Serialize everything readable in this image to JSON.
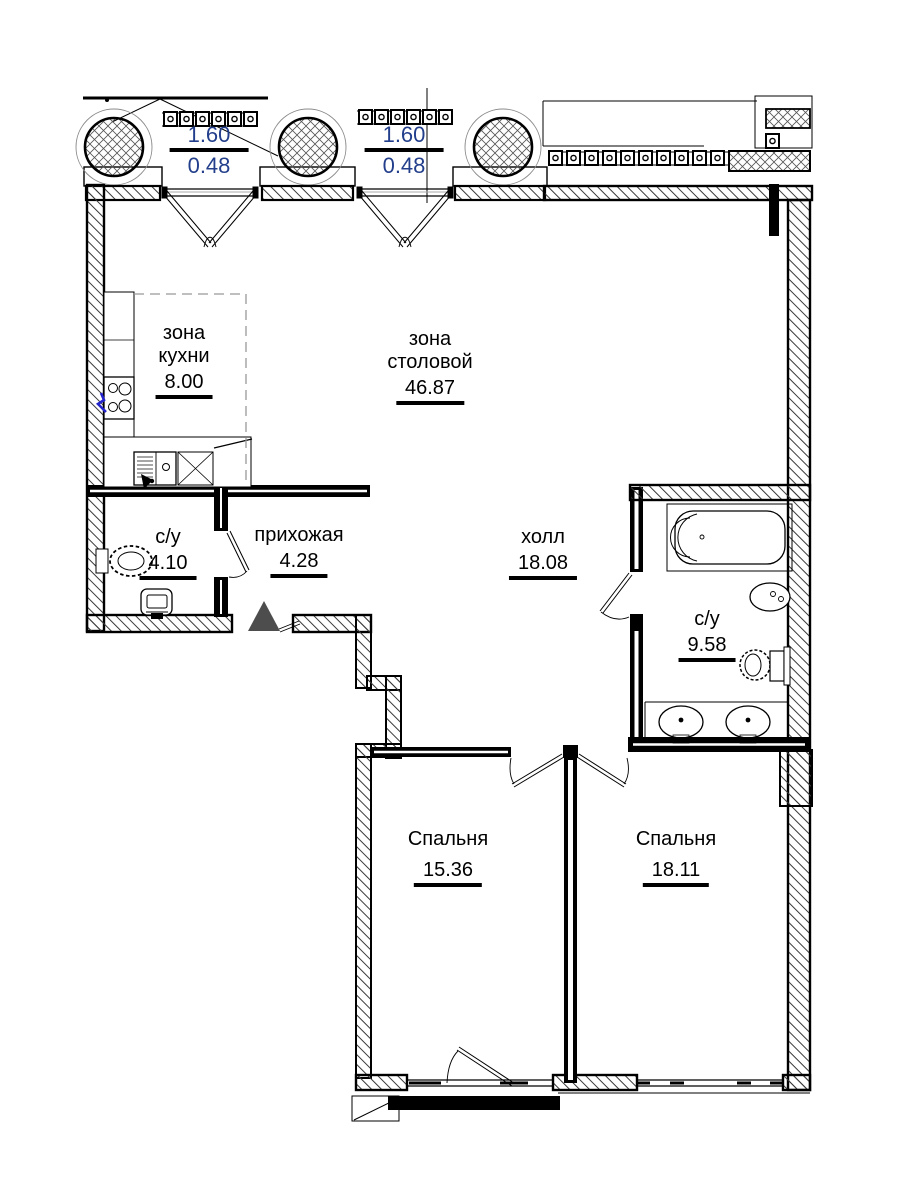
{
  "plan": {
    "kind": "apartment floor plan",
    "language": "ru"
  },
  "colors": {
    "wall": "#000000",
    "dimension_text": "#233f8c",
    "entrance_marker": "#4d4d4d",
    "faucet_accent": "#2323cc",
    "paper": "#ffffff"
  },
  "rooms": {
    "kitchen": {
      "line1": "зона",
      "line2": "кухни",
      "area": "8.00"
    },
    "dining": {
      "line1": "зона",
      "line2": "столовой",
      "area": "46.87"
    },
    "bathroom_left": {
      "name": "с/у",
      "area": "4.10"
    },
    "hallway": {
      "name": "прихожая",
      "area": "4.28"
    },
    "hall": {
      "name": "холл",
      "area": "18.08"
    },
    "bathroom_right": {
      "name": "с/у",
      "area": "9.58"
    },
    "bedroom_1": {
      "name": "Спальня",
      "area": "15.36"
    },
    "bedroom_2": {
      "name": "Спальня",
      "area": "18.11"
    }
  },
  "windows": {
    "window_1": {
      "width": "1.60",
      "sill": "0.48"
    },
    "window_2": {
      "width": "1.60",
      "sill": "0.48"
    }
  }
}
